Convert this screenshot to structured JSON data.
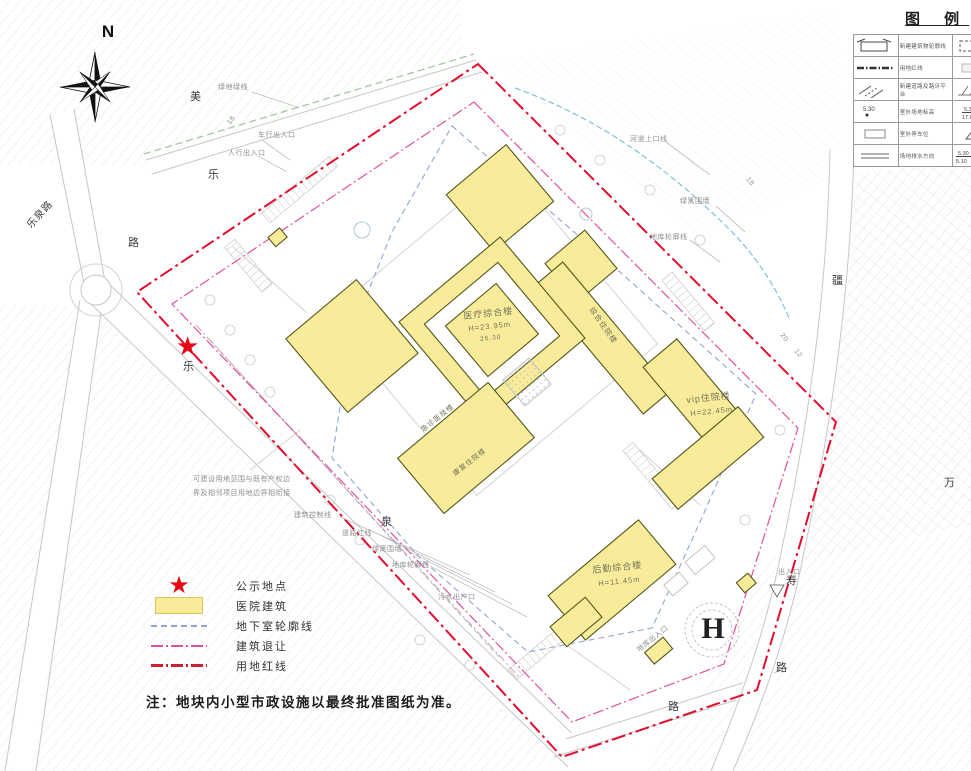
{
  "note": "注：地块内小型市政设施以最终批准图纸为准。",
  "compass_label": "N",
  "helipad_label": "H",
  "legend_panel": {
    "title": "图 例",
    "rows": [
      {
        "ls": "newbuild",
        "ll": "新建建筑物轮廓线",
        "rs": "dashrect",
        "rl": "地下室轮廓线"
      },
      {
        "ls": "redline",
        "ll": "用地红线",
        "rs": "lightrect",
        "rl": "绿化用地"
      },
      {
        "ls": "road",
        "ll": "新建道路及路牙平台",
        "rs": "slope",
        "rl": "放坡边线"
      },
      {
        "ls": "spot",
        "ll": "室外场地标高",
        "rs": "frac",
        "rl": "场地标高"
      },
      {
        "ls": "stall",
        "ll": "室外停车位",
        "rs": "tri",
        "rl": "场地出入口"
      },
      {
        "ls": "drain",
        "ll": "场地排水方向",
        "rs": "frac2",
        "rl": "坡度标注"
      }
    ]
  },
  "map_legend": [
    {
      "sym": "star",
      "label": "公示地点"
    },
    {
      "sym": "swatch-yellow",
      "label": "医院建筑"
    },
    {
      "sym": "line-blue",
      "label": "地下室轮廓线"
    },
    {
      "sym": "line-pink",
      "label": "建筑退让"
    },
    {
      "sym": "line-red",
      "label": "用地红线"
    }
  ],
  "building_labels": [
    {
      "text": "医疗综合楼",
      "x": 463,
      "y": 312,
      "rot": -6,
      "size": 9
    },
    {
      "text": "H=23.95m",
      "x": 468,
      "y": 325,
      "rot": -6,
      "size": 7.5
    },
    {
      "text": "26.30",
      "x": 480,
      "y": 337,
      "rot": -6,
      "size": 6.5
    },
    {
      "text": "vip住院楼",
      "x": 686,
      "y": 396,
      "rot": -6,
      "size": 9
    },
    {
      "text": "H=22.45m",
      "x": 690,
      "y": 410,
      "rot": -6,
      "size": 7.5
    },
    {
      "text": "后勤综合楼",
      "x": 592,
      "y": 566,
      "rot": -6,
      "size": 9
    },
    {
      "text": "H=11.45m",
      "x": 598,
      "y": 580,
      "rot": -6,
      "size": 7.5
    },
    {
      "text": "综合住院楼",
      "x": 594,
      "y": 306,
      "rot": 55,
      "size": 7.5
    },
    {
      "text": "急诊医技楼",
      "x": 420,
      "y": 428,
      "rot": -38,
      "size": 7
    },
    {
      "text": "康复住院楼",
      "x": 452,
      "y": 472,
      "rot": -38,
      "size": 7
    }
  ],
  "road_labels": [
    {
      "text": "乐泉路",
      "x": 26,
      "y": 224,
      "rot": -48,
      "size": 10
    },
    {
      "text": "乐",
      "x": 208,
      "y": 170
    },
    {
      "text": "路",
      "x": 128,
      "y": 238
    },
    {
      "text": "美",
      "x": 190,
      "y": 92
    },
    {
      "text": "乐",
      "x": 183,
      "y": 362
    },
    {
      "text": "泉",
      "x": 381,
      "y": 517
    },
    {
      "text": "路",
      "x": 668,
      "y": 702
    },
    {
      "text": "疆",
      "x": 832,
      "y": 276
    },
    {
      "text": "万",
      "x": 944,
      "y": 478
    },
    {
      "text": "寿",
      "x": 786,
      "y": 576
    },
    {
      "text": "路",
      "x": 776,
      "y": 663
    }
  ],
  "annotations": [
    {
      "text": "绿地绿线",
      "x": 218,
      "y": 84
    },
    {
      "text": "车行出入口",
      "x": 258,
      "y": 132
    },
    {
      "text": "人行出入口",
      "x": 228,
      "y": 150
    },
    {
      "text": "河道上口线",
      "x": 630,
      "y": 136
    },
    {
      "text": "绿篱围墙",
      "x": 680,
      "y": 198
    },
    {
      "text": "地库轮廓线",
      "x": 650,
      "y": 234
    },
    {
      "text": "可建设用地范围与既有产权边",
      "x": 193,
      "y": 476
    },
    {
      "text": "界及相邻项目用地边界相衔接",
      "x": 193,
      "y": 490
    },
    {
      "text": "建筑控制线",
      "x": 294,
      "y": 512
    },
    {
      "text": "道路红线",
      "x": 342,
      "y": 530
    },
    {
      "text": "绿篱围墙",
      "x": 372,
      "y": 546
    },
    {
      "text": "地库轮廓线",
      "x": 392,
      "y": 562
    },
    {
      "text": "污水出户口",
      "x": 438,
      "y": 594
    },
    {
      "text": "出入口",
      "x": 778,
      "y": 569
    },
    {
      "text": "地库出入口",
      "x": 636,
      "y": 648,
      "rot": -38
    },
    {
      "text": "18",
      "x": 226,
      "y": 122,
      "rot": -55
    },
    {
      "text": "18",
      "x": 750,
      "y": 176,
      "rot": 52
    },
    {
      "text": "20",
      "x": 784,
      "y": 332,
      "rot": 52
    },
    {
      "text": "12",
      "x": 798,
      "y": 348,
      "rot": 52
    }
  ],
  "colors": {
    "building_fill": "#f8ec9b",
    "building_stroke": "#55551a",
    "red_line": "#e30b2d",
    "setback_pink": "#e0519e",
    "basement_blue": "#8fa6cf",
    "river_cyan": "#7cc4d4",
    "green_line": "#9cc49c",
    "road_gray": "#c6c6c6",
    "star_red": "#e50914"
  }
}
